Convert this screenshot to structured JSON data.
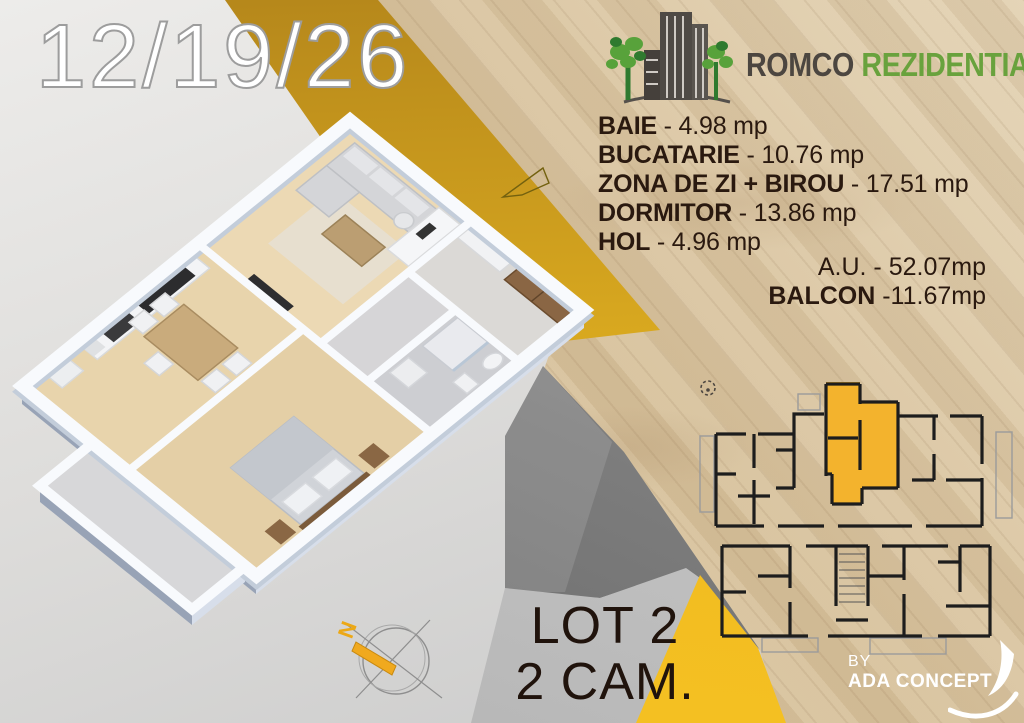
{
  "date_label": "12/19/26",
  "brand": {
    "primary": "ROMCO",
    "secondary": "REZIDENTIAL"
  },
  "rooms": [
    {
      "label": "BAIE",
      "value": " - 4.98 mp"
    },
    {
      "label": "BUCATARIE",
      "value": " - 10.76 mp"
    },
    {
      "label": "ZONA DE ZI + BIROU",
      "value": " - 17.51 mp"
    },
    {
      "label": "DORMITOR",
      "value": " - 13.86 mp"
    },
    {
      "label": "HOL",
      "value": " - 4.96 mp"
    }
  ],
  "totals": {
    "au_label": "A.U.",
    "au_value": " - 52.07mp",
    "balcon_label": "BALCON",
    "balcon_value": " -11.67mp"
  },
  "lot": {
    "line1": "LOT 2",
    "line2": "2 CAM."
  },
  "credit": {
    "by": "BY",
    "name": "ADA CONCEPT"
  },
  "compass_label": "N",
  "colors": {
    "accent_yellow": "#f2b52b",
    "mustard": "#c2901c",
    "brand_green": "#69a23d",
    "brand_gray": "#4c4640",
    "text_dark": "#2a190f"
  }
}
